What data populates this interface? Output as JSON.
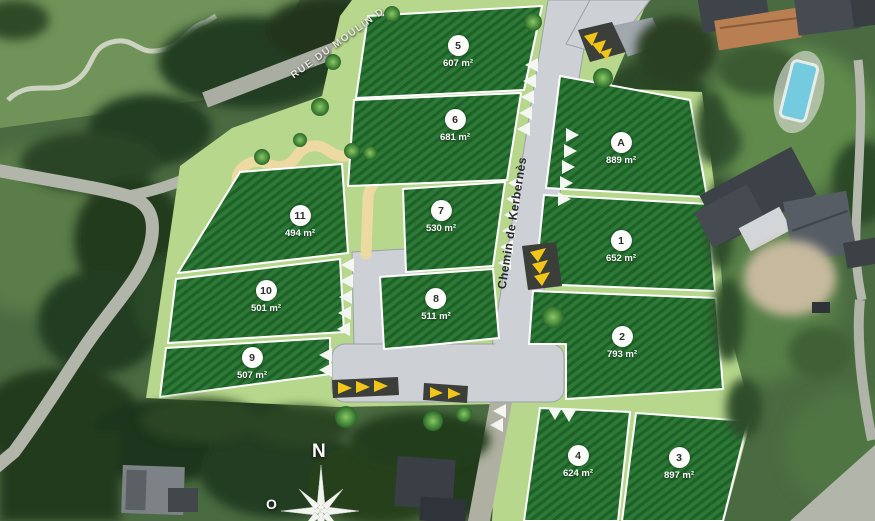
{
  "roads": {
    "main_label": "Chemin de Kerbernès",
    "top_label": "RUE DU MOULIN D"
  },
  "compass": {
    "north": "N",
    "west": "O"
  },
  "lots": [
    {
      "id": "5",
      "area": "607 m²"
    },
    {
      "id": "6",
      "area": "681 m²"
    },
    {
      "id": "7",
      "area": "530 m²"
    },
    {
      "id": "8",
      "area": "511 m²"
    },
    {
      "id": "11",
      "area": "494 m²"
    },
    {
      "id": "10",
      "area": "501 m²"
    },
    {
      "id": "9",
      "area": "507 m²"
    },
    {
      "id": "A",
      "area": "889 m²"
    },
    {
      "id": "1",
      "area": "652 m²"
    },
    {
      "id": "2",
      "area": "793 m²"
    },
    {
      "id": "4",
      "area": "624 m²"
    },
    {
      "id": "3",
      "area": "897 m²"
    }
  ],
  "colors": {
    "plot_green": "#2c7a36",
    "plot_green_dark": "#1f6029",
    "plan_light_green": "#b7d78c",
    "road_gray": "#cdd1d6",
    "path_beige": "#ecdaa2",
    "bump_yellow": "#f2c618",
    "bump_dark": "#3b3e39",
    "pool_blue": "#74cade"
  }
}
